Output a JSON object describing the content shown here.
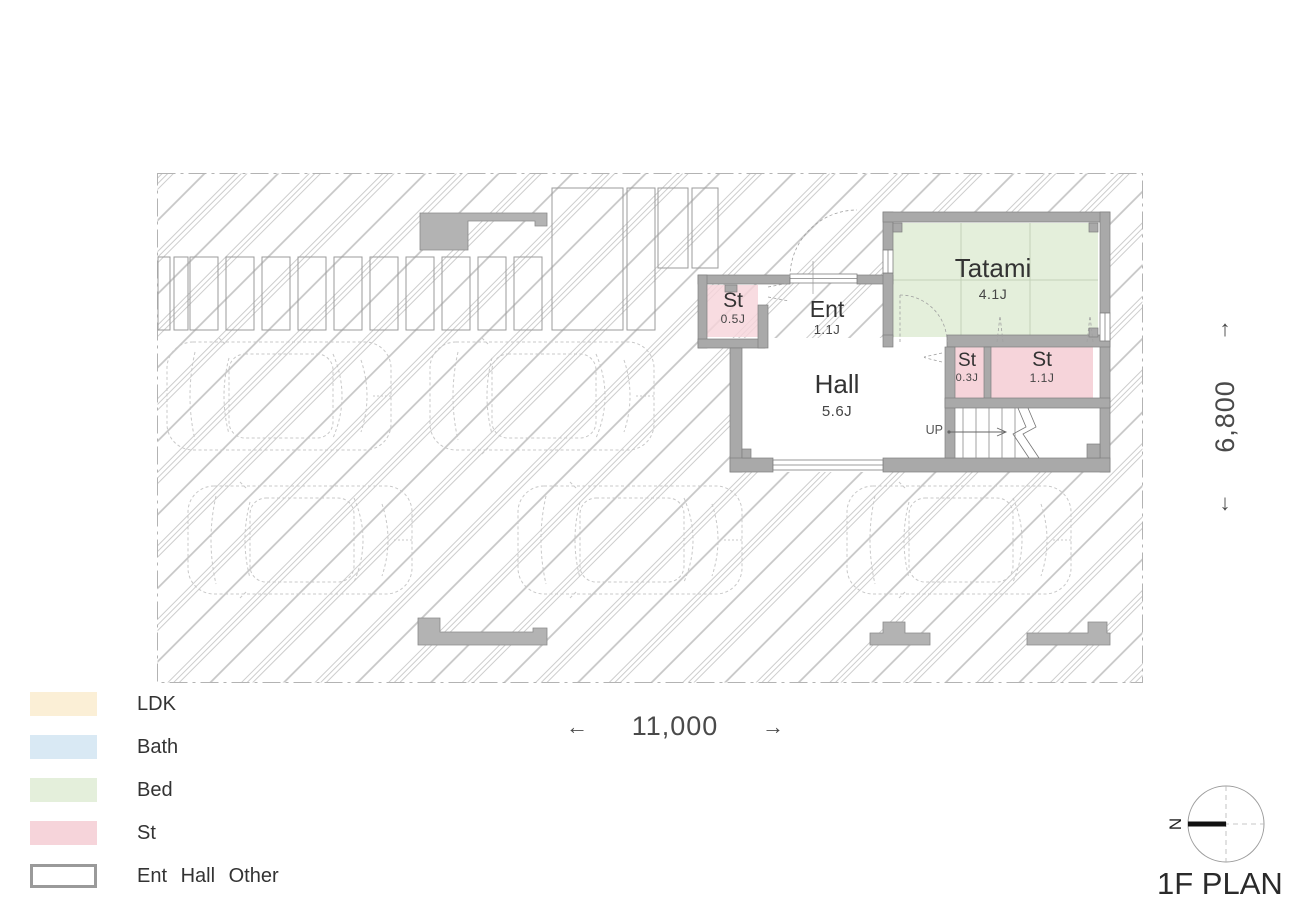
{
  "title": "1F PLAN",
  "compass": {
    "north_label": "N"
  },
  "dimensions": {
    "width": {
      "value": "11,000",
      "arrow_left": "←",
      "arrow_right": "→"
    },
    "height": {
      "value": "6,800",
      "arrow_up": "↑",
      "arrow_down": "↓"
    }
  },
  "plan": {
    "rooms": [
      {
        "name": "St",
        "area": "0.5J",
        "type": "st"
      },
      {
        "name": "Ent",
        "area": "1.1J",
        "type": "ent"
      },
      {
        "name": "Tatami",
        "area": "4.1J",
        "type": "bed"
      },
      {
        "name": "Hall",
        "area": "5.6J",
        "type": "hall"
      },
      {
        "name": "St",
        "area": "0.3J",
        "type": "st"
      },
      {
        "name": "St",
        "area": "1.1J",
        "type": "st"
      }
    ],
    "stairs_label": "UP"
  },
  "legend": {
    "items": [
      {
        "label": "LDK",
        "color": "#fbefd6"
      },
      {
        "label": "Bath",
        "color": "#d9e9f4"
      },
      {
        "label": "Bed",
        "color": "#e4efdb"
      },
      {
        "label": "St",
        "color": "#f6d4da"
      },
      {
        "label": "Ent Hall Other",
        "color": "#ffffff"
      }
    ]
  },
  "colors": {
    "bed": "#e4efdb",
    "st": "#f6d4da",
    "wall": "#a9a9a9",
    "hatch_line": "#cdcdcd"
  }
}
